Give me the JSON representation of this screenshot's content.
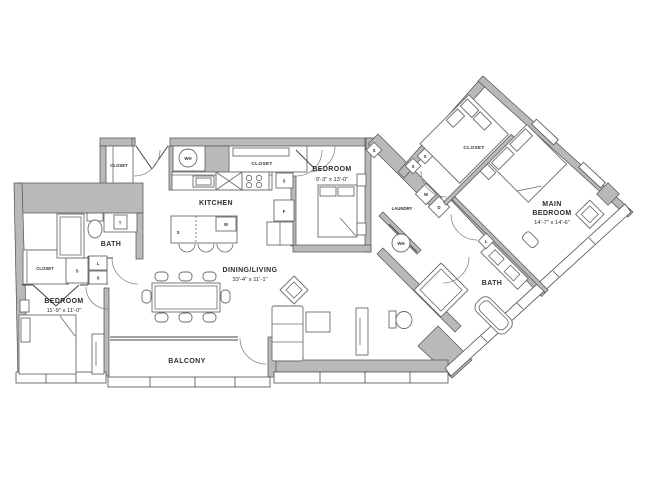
{
  "plan": {
    "colors": {
      "wall_fill": "#b9b9b9",
      "wall_edge": "#4f4f4f",
      "fixture_line": "#6a6a6a",
      "text": "#2e2e2e"
    },
    "rooms": {
      "kitchen": {
        "label": "KITCHEN"
      },
      "dining_living": {
        "label": "DINING/LIVING",
        "dims": "33'-4\" x 11'-1\""
      },
      "balcony": {
        "label": "BALCONY"
      },
      "bedroom_left": {
        "label": "BEDROOM",
        "dims": "11'-9\" x 11'-0\""
      },
      "bedroom_mid": {
        "label": "BEDROOM",
        "dims": "9'-3\" x 13'-0\""
      },
      "main_bedroom": {
        "line1": "MAIN",
        "line2": "BEDROOM",
        "dims": "14'-7\" x 14'-6\""
      },
      "bath_left": {
        "label": "BATH"
      },
      "bath_right": {
        "label": "BATH"
      },
      "laundry": {
        "label": "LAUNDRY"
      },
      "closet_entry": {
        "label": "CLOSET"
      },
      "closet_kitchen": {
        "label": "CLOSET"
      },
      "closet_bedroom_left": {
        "label": "CLOSET"
      },
      "closet_main": {
        "label": "CLOSET"
      }
    },
    "tags": {
      "water_heater_1": "WH",
      "water_heater_2": "WH",
      "washer": "W",
      "dryer": "D",
      "fridge": "F",
      "pantry_s": "S",
      "island_s": "S",
      "island_w": "W",
      "linen_l_left": "L",
      "shelf_s_left": "S",
      "closet_s_left": "S",
      "towel_t": "T",
      "bedroom_mid_s": "S",
      "laundry_s1": "S",
      "laundry_s2": "S",
      "bath_right_l": "L"
    }
  }
}
